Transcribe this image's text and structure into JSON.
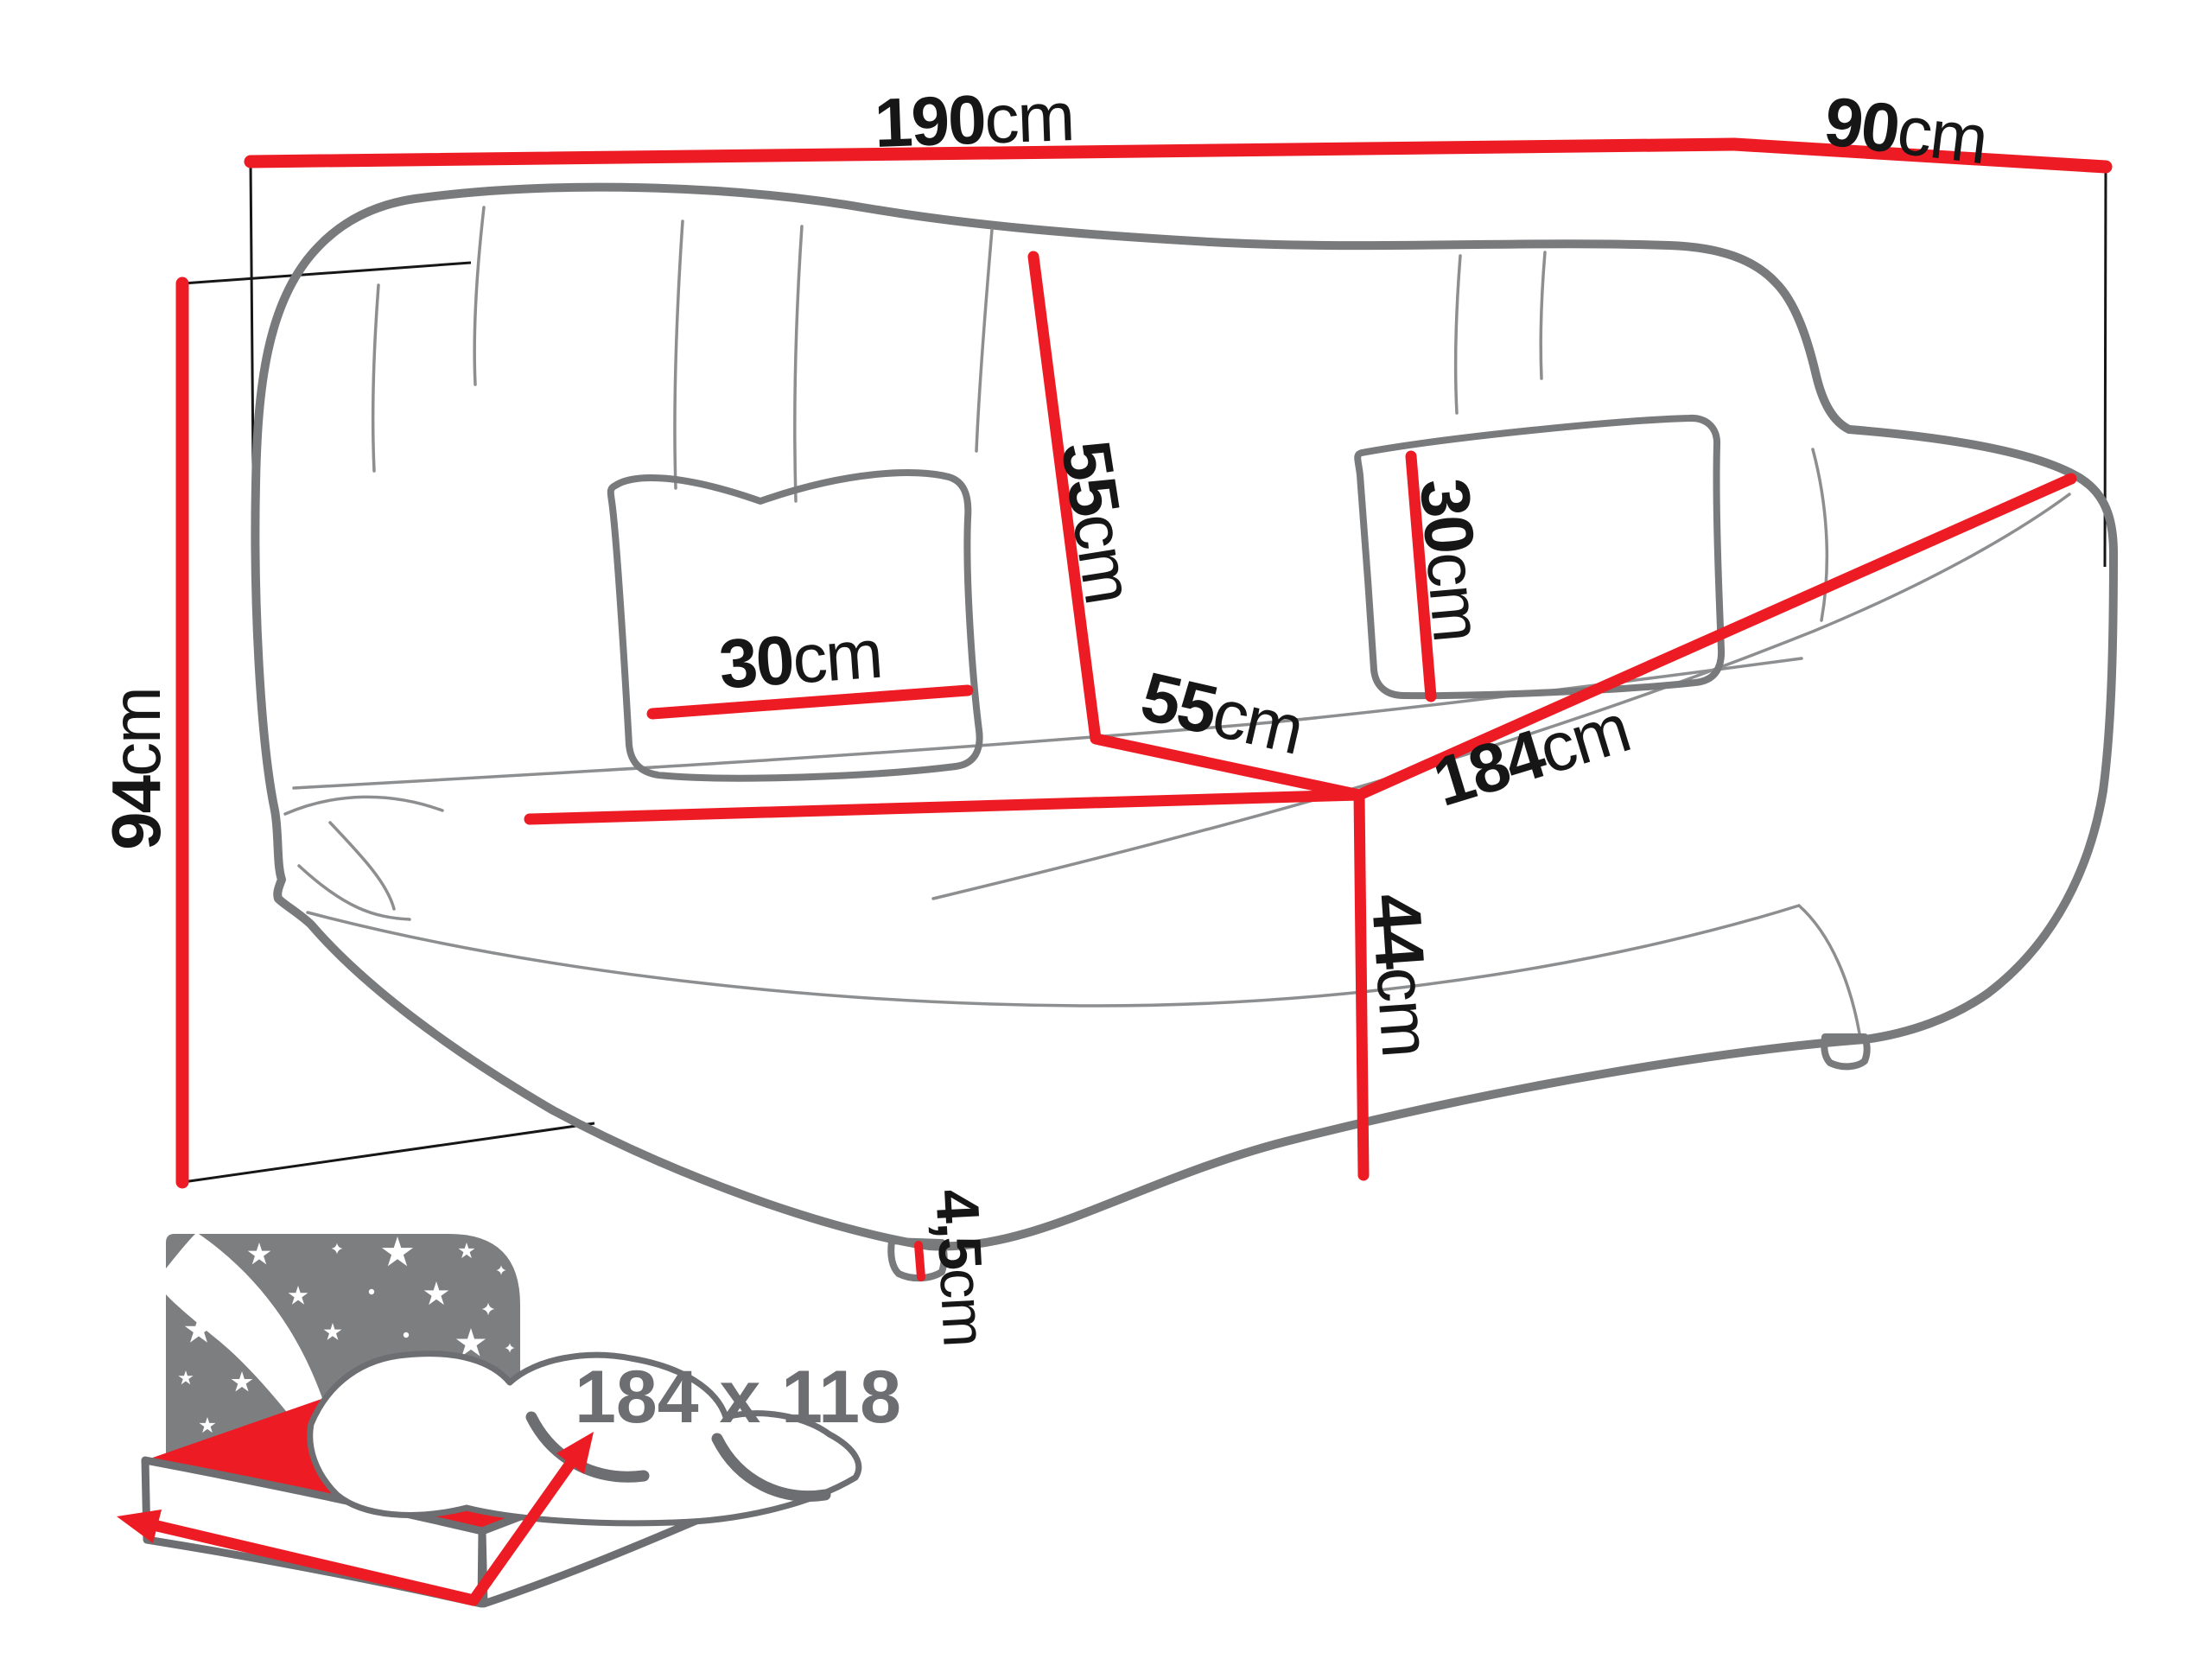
{
  "labels": {
    "width": {
      "num": "190",
      "unit": "cm"
    },
    "depth": {
      "num": "90",
      "unit": "cm"
    },
    "height": {
      "num": "94",
      "unit": "cm"
    },
    "backrest": {
      "num": "55",
      "unit": "cm"
    },
    "seat_depth": {
      "num": "55",
      "unit": "cm"
    },
    "seat_width": {
      "num": "184",
      "unit": "cm"
    },
    "seat_height": {
      "num": "44",
      "unit": "cm"
    },
    "pillow_left": {
      "num": "30",
      "unit": "cm"
    },
    "pillow_right": {
      "num": "30",
      "unit": "cm"
    },
    "leg_height": {
      "num": "4,5",
      "unit": "cm"
    }
  },
  "sleeping_area": {
    "text": "184 x 118"
  },
  "colors": {
    "red": "#ed1c24",
    "outline": "#797a7c",
    "seam": "#8d8e90",
    "label": "#161616",
    "icon_gray": "#7d7e80",
    "icon_outline": "#6d6e71",
    "size_text": "#6d6e71"
  }
}
